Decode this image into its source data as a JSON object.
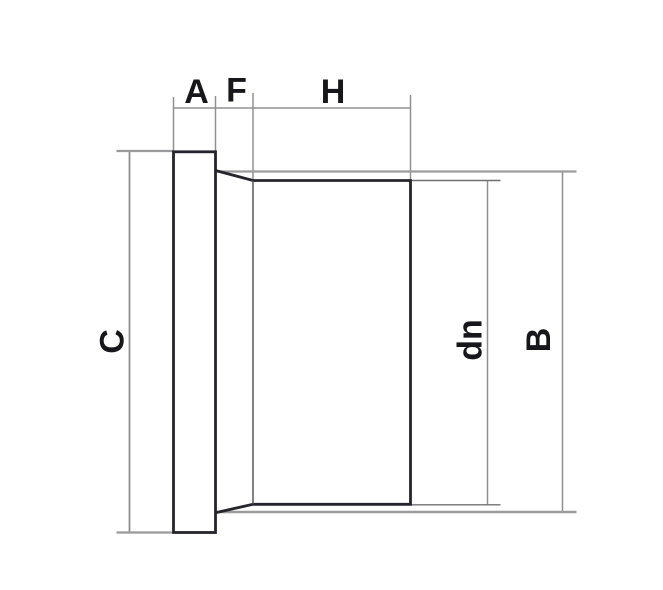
{
  "drawing": {
    "labels": {
      "a": "A",
      "f": "F",
      "h": "H",
      "c": "C",
      "dn": "dn",
      "b": "B"
    },
    "colors": {
      "background": "#ffffff",
      "outline": "#25252b",
      "transition_edge": "#4a4a52",
      "dimension_line": "#909090",
      "label_text": "#17171b"
    }
  }
}
